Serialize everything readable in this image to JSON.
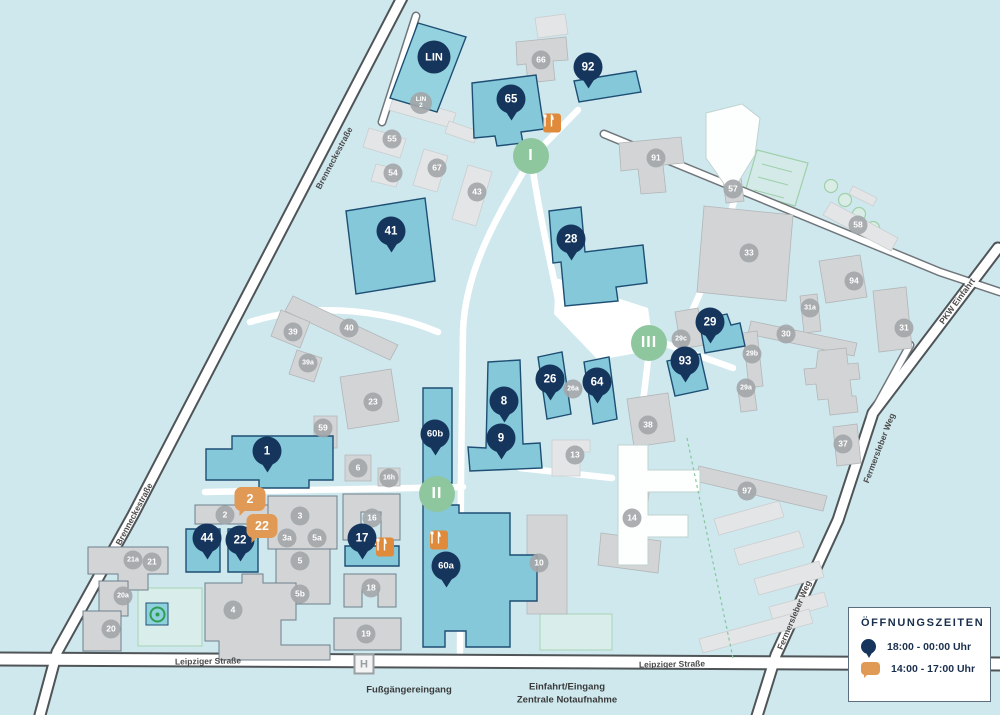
{
  "colors": {
    "background": "#cee8ee",
    "building_teal": "#84c8d9",
    "building_teal_border": "#1e4e73",
    "building_gray": "#d2d4d5",
    "pin_navy": "#16355c",
    "bubble_orange": "#e09a55",
    "food_orange": "#e08a3c",
    "entrance_green": "#8ec69d",
    "badge_gray": "#a3a6a9",
    "meeting_green": "#2f9e53"
  },
  "legend": {
    "title": "ÖFFNUNGSZEITEN",
    "entries": [
      {
        "icon": "pin-icon",
        "label": "18:00 - 00:00 Uhr"
      },
      {
        "icon": "bubble-icon",
        "label": "14:00 - 17:00 Uhr"
      }
    ]
  },
  "map": {
    "streets": [
      {
        "label": "Brenneckestraße",
        "x": 334,
        "y": 158,
        "angle": -62
      },
      {
        "label": "Brenneckestraße",
        "x": 134,
        "y": 514,
        "angle": -62
      },
      {
        "label": "Leipziger Straße",
        "x": 208,
        "y": 661,
        "angle": -1
      },
      {
        "label": "Leipziger Straße",
        "x": 672,
        "y": 664,
        "angle": -1
      },
      {
        "label": "Fermersleber Weg",
        "x": 879,
        "y": 448,
        "angle": -69
      },
      {
        "label": "Fermersleber Weg",
        "x": 794,
        "y": 615,
        "angle": -67
      },
      {
        "label": "PKW Einfahrt",
        "x": 957,
        "y": 301,
        "angle": -54
      }
    ],
    "captions": [
      {
        "label": "Fußgängereingang",
        "x": 409,
        "y": 690
      },
      {
        "label": "Einfahrt/Eingang",
        "x": 567,
        "y": 687
      },
      {
        "label": "Zentrale Notaufnahme",
        "x": 567,
        "y": 700
      }
    ],
    "pins": [
      {
        "label": "65",
        "x": 511,
        "y": 99
      },
      {
        "label": "92",
        "x": 588,
        "y": 67
      },
      {
        "label": "41",
        "x": 391,
        "y": 231
      },
      {
        "label": "28",
        "x": 571,
        "y": 239
      },
      {
        "label": "29",
        "x": 710,
        "y": 322
      },
      {
        "label": "93",
        "x": 685,
        "y": 361
      },
      {
        "label": "26",
        "x": 550,
        "y": 379
      },
      {
        "label": "64",
        "x": 597,
        "y": 382
      },
      {
        "label": "8",
        "x": 504,
        "y": 401
      },
      {
        "label": "9",
        "x": 501,
        "y": 438
      },
      {
        "label": "60b",
        "x": 435,
        "y": 434
      },
      {
        "label": "1",
        "x": 267,
        "y": 451
      },
      {
        "label": "44",
        "x": 207,
        "y": 538
      },
      {
        "label": "22",
        "x": 240,
        "y": 540
      },
      {
        "label": "17",
        "x": 362,
        "y": 538
      },
      {
        "label": "60a",
        "x": 446,
        "y": 566
      }
    ],
    "special": [
      {
        "label": "LIN",
        "x": 434,
        "y": 57
      }
    ],
    "bubbles": [
      {
        "label": "2",
        "x": 250,
        "y": 499
      },
      {
        "label": "22",
        "x": 262,
        "y": 526
      }
    ],
    "romans": [
      {
        "label": "I",
        "x": 531,
        "y": 156
      },
      {
        "label": "II",
        "x": 437,
        "y": 494
      },
      {
        "label": "III",
        "x": 649,
        "y": 343
      }
    ],
    "badges": [
      {
        "label": "66",
        "x": 541,
        "y": 60
      },
      {
        "label": "55",
        "x": 392,
        "y": 139
      },
      {
        "label": "54",
        "x": 393,
        "y": 173
      },
      {
        "label": "67",
        "x": 437,
        "y": 168
      },
      {
        "label": "43",
        "x": 477,
        "y": 192
      },
      {
        "label": "LIN 2",
        "x": 421,
        "y": 103
      },
      {
        "label": "91",
        "x": 656,
        "y": 158
      },
      {
        "label": "57",
        "x": 733,
        "y": 189
      },
      {
        "label": "33",
        "x": 749,
        "y": 253
      },
      {
        "label": "58",
        "x": 858,
        "y": 225
      },
      {
        "label": "94",
        "x": 854,
        "y": 281
      },
      {
        "label": "31a",
        "x": 810,
        "y": 308
      },
      {
        "label": "30",
        "x": 786,
        "y": 334
      },
      {
        "label": "29c",
        "x": 681,
        "y": 339
      },
      {
        "label": "29b",
        "x": 752,
        "y": 354
      },
      {
        "label": "29a",
        "x": 746,
        "y": 388
      },
      {
        "label": "31",
        "x": 904,
        "y": 328
      },
      {
        "label": "37",
        "x": 843,
        "y": 444
      },
      {
        "label": "38",
        "x": 648,
        "y": 425
      },
      {
        "label": "26a",
        "x": 573,
        "y": 389
      },
      {
        "label": "13",
        "x": 575,
        "y": 455
      },
      {
        "label": "40",
        "x": 349,
        "y": 328
      },
      {
        "label": "39",
        "x": 293,
        "y": 332
      },
      {
        "label": "39a",
        "x": 308,
        "y": 363
      },
      {
        "label": "23",
        "x": 373,
        "y": 402
      },
      {
        "label": "59",
        "x": 323,
        "y": 428
      },
      {
        "label": "6",
        "x": 358,
        "y": 468
      },
      {
        "label": "16h",
        "x": 389,
        "y": 478
      },
      {
        "label": "16",
        "x": 372,
        "y": 518
      },
      {
        "label": "18",
        "x": 371,
        "y": 588
      },
      {
        "label": "19",
        "x": 366,
        "y": 634
      },
      {
        "label": "2",
        "x": 225,
        "y": 515
      },
      {
        "label": "3",
        "x": 300,
        "y": 516
      },
      {
        "label": "3a",
        "x": 287,
        "y": 538
      },
      {
        "label": "5a",
        "x": 317,
        "y": 538
      },
      {
        "label": "5",
        "x": 300,
        "y": 561
      },
      {
        "label": "5b",
        "x": 300,
        "y": 594
      },
      {
        "label": "4",
        "x": 233,
        "y": 610
      },
      {
        "label": "21a",
        "x": 133,
        "y": 560
      },
      {
        "label": "21",
        "x": 152,
        "y": 562
      },
      {
        "label": "20a",
        "x": 123,
        "y": 596
      },
      {
        "label": "20",
        "x": 111,
        "y": 629
      },
      {
        "label": "10",
        "x": 539,
        "y": 563
      },
      {
        "label": "14",
        "x": 632,
        "y": 518
      },
      {
        "label": "97",
        "x": 747,
        "y": 491
      }
    ],
    "food": [
      {
        "x": 552,
        "y": 123
      },
      {
        "x": 385,
        "y": 547
      },
      {
        "x": 439,
        "y": 540
      }
    ],
    "bus_stop": {
      "label": "H",
      "x": 364,
      "y": 664
    },
    "meeting_point": {
      "x": 157,
      "y": 614
    }
  }
}
